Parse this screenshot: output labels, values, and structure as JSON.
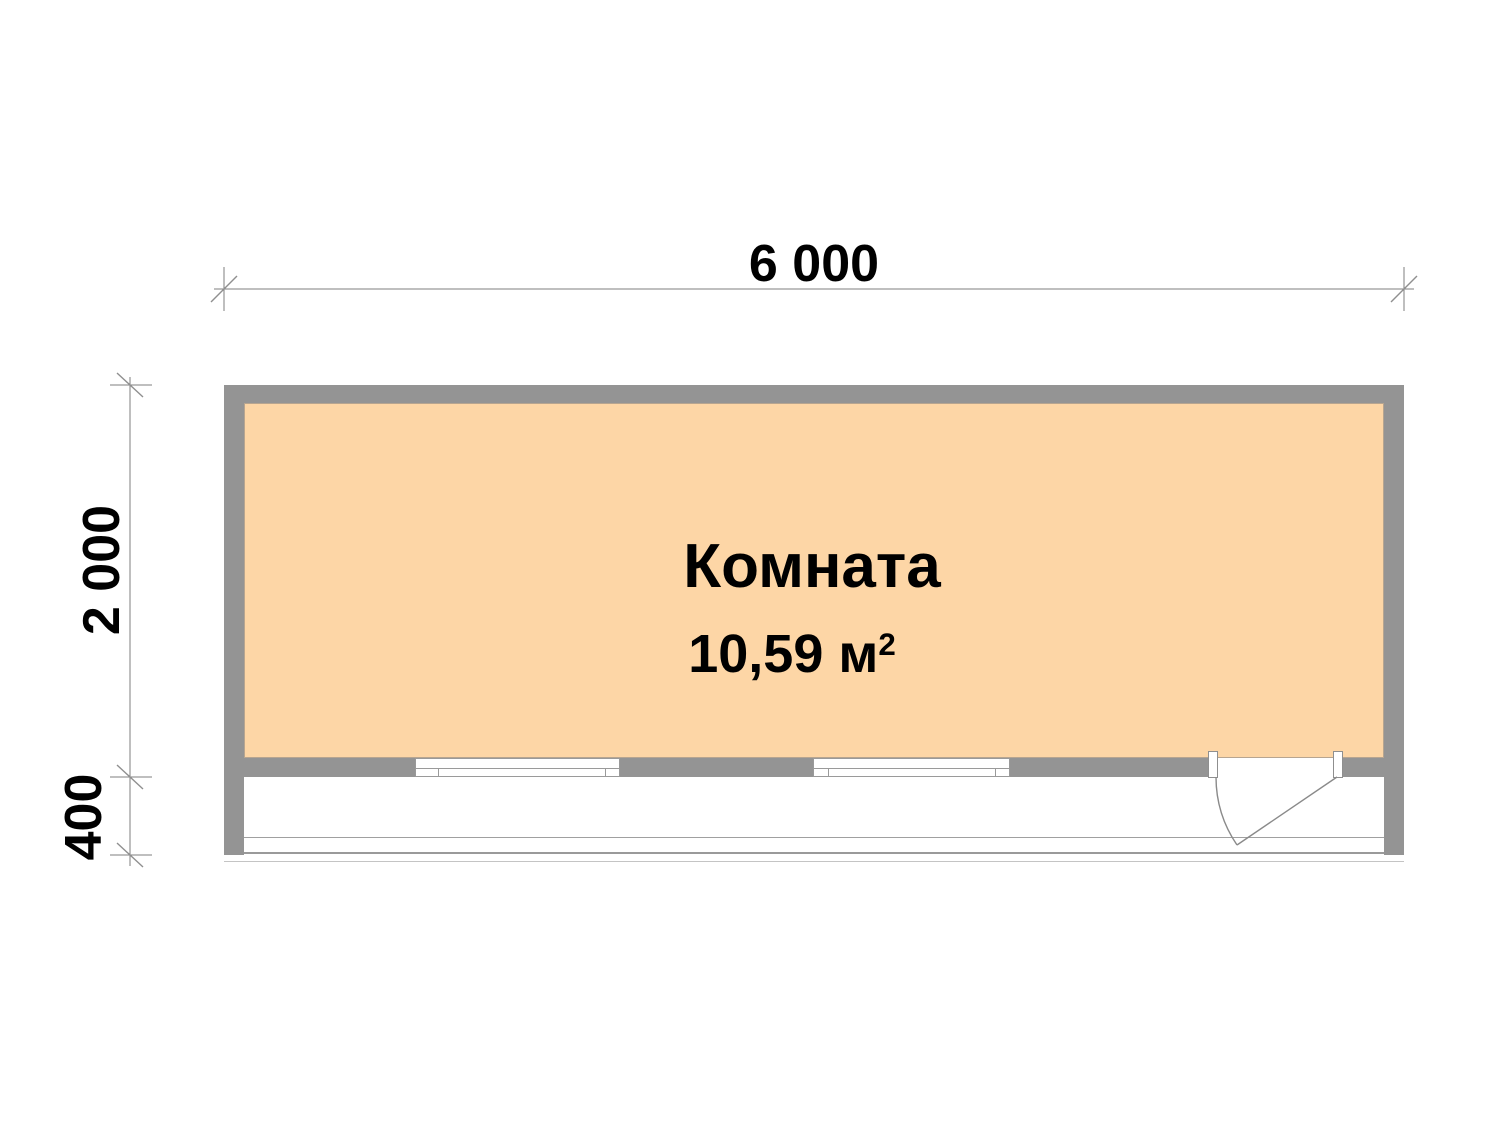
{
  "drawing": {
    "type": "floor-plan",
    "dimensions": {
      "total_width_mm": "6 000",
      "room_depth_mm": "2 000",
      "porch_depth_mm": "400"
    },
    "room": {
      "name": "Комната",
      "area_value": "10,59 м",
      "area_superscript": "2"
    },
    "colors": {
      "room_fill": "#fdd6a6",
      "wall": "#949494",
      "dimension_line": "#7f7f7f",
      "text": "#000000",
      "background": "#ffffff"
    }
  }
}
